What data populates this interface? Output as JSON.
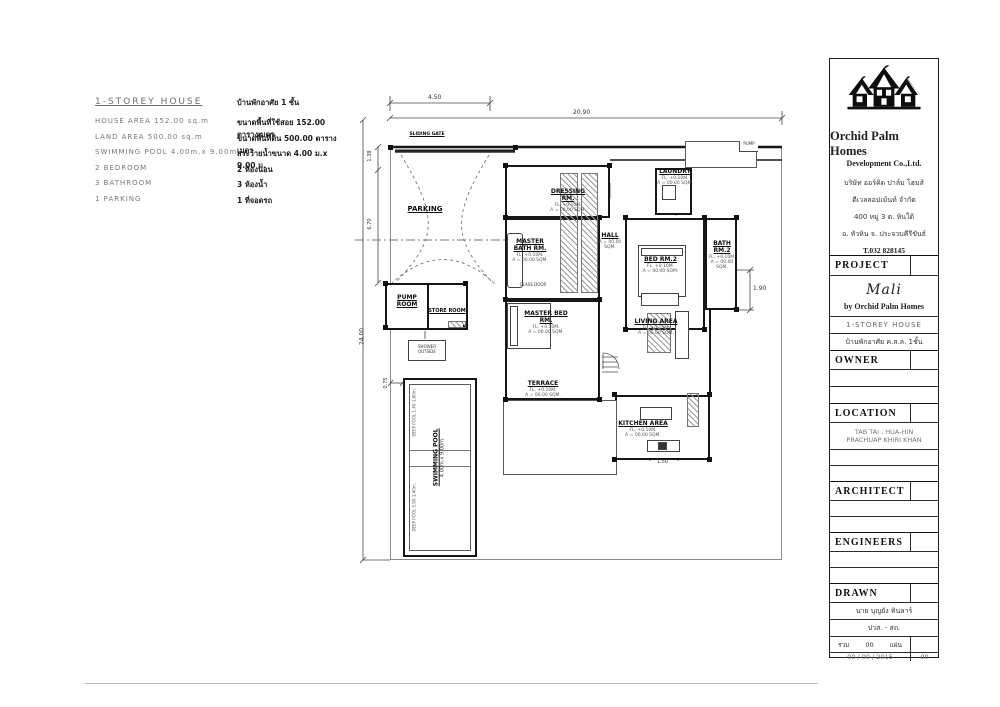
{
  "specs": {
    "title_en": "1-STOREY HOUSE",
    "title_th": "บ้านพักอาศัย 1 ชั้น",
    "rows": [
      {
        "en": "HOUSE AREA 152.00 sq.m",
        "th": "ขนาดพื้นที่ใช้สอย 152.00 ตารางเมตร"
      },
      {
        "en": "LAND AREA 500.00 sq.m",
        "th": "ขนาดพื้นที่ดิน 500.00 ตารางเมตร"
      },
      {
        "en": "SWIMMING POOL 4.00m.x 9.00m.",
        "th": "สระว่ายน้ำขนาด 4.00 ม.x 9.00 ม."
      },
      {
        "en": "2 BEDROOM",
        "th": "2 ห้องนอน"
      },
      {
        "en": "3 BATHROOM",
        "th": "3 ห้องน้ำ"
      },
      {
        "en": "1 PARKING",
        "th": "1 ที่จอดรถ"
      }
    ]
  },
  "titleblock": {
    "company": {
      "name": "Orchid Palm Homes",
      "subtitle": "Development Co.,Ltd.",
      "address1": "บริษัท ออร์คิด ปาล์ม โฮมส์",
      "address2": "ดีเวลลอปเม้นท์ จำกัด",
      "address3": "400 หมู่ 3 ต. หินใต้",
      "address4": "อ. หัวหิน จ. ประจวบคีรีขันธ์",
      "phone": "T.032 828145"
    },
    "project": {
      "label": "PROJECT",
      "name": "Mali",
      "by": "by Orchid Palm Homes",
      "type_en": "1-STOREY  HOUSE",
      "type_th": "บ้านพักอาศัย ค.ส.ล. 1ชั้น"
    },
    "owner_label": "OWNER",
    "location": {
      "label": "LOCATION",
      "line1": "TAB TAI , HUA-HIN",
      "line2": "PRACHUAP KHIRI KHAN"
    },
    "architect_label": "ARCHITECT",
    "engineers_label": "ENGINEERS",
    "drawn": {
      "label": "DRAWN",
      "name": "นาย บุญยัง ทินลาร์",
      "cert": "ปวส. - สถ.",
      "total_label": "รวม",
      "total_value": "00",
      "sheet_label": "แผ่น",
      "date": "00 / 00 / 2015",
      "page": "00"
    }
  },
  "plan": {
    "dims": {
      "d450": "4.50",
      "d2090": "20.90",
      "d2400": "24.00",
      "d138": "1.38",
      "d670": "6.70",
      "d075": "0.75",
      "d190": "1.90",
      "d150": "1.50"
    },
    "labels": {
      "sliding_gate": "SLIDING GATE",
      "parking": "PARKING",
      "pump_room": "PUMP ROOM",
      "store_room": "STORE ROOM",
      "shower_outside": "SHOWER OUTSIDE",
      "dressing": "DRESSING RM.",
      "laundry": "LAUNDRY",
      "master_bath": "MASTER BATH RM.",
      "hall": "HALL",
      "bed2": "BED RM.2",
      "bath2": "BATH RM.2",
      "master_bed": "MASTER BED RM.",
      "living": "LIVING AREA",
      "terrace": "TERRACE",
      "kitchen": "KITCHEN AREA",
      "glass_door": "GLASS DOOR",
      "pump_small": "PUMP"
    },
    "pool": {
      "name": "SWIMMING POOL",
      "size": "4.00m.x 9.00m.",
      "deep_top": "DEEP POOL 1.40-1.80m.",
      "deep_bottom": "DEEP POOL 0.90-1.40m."
    },
    "sub1": "FL. +0.10M.",
    "sub2": "A = 00.00 SQM."
  },
  "colors": {
    "ink": "#161616",
    "dim": "#333333",
    "faint": "#888888"
  }
}
